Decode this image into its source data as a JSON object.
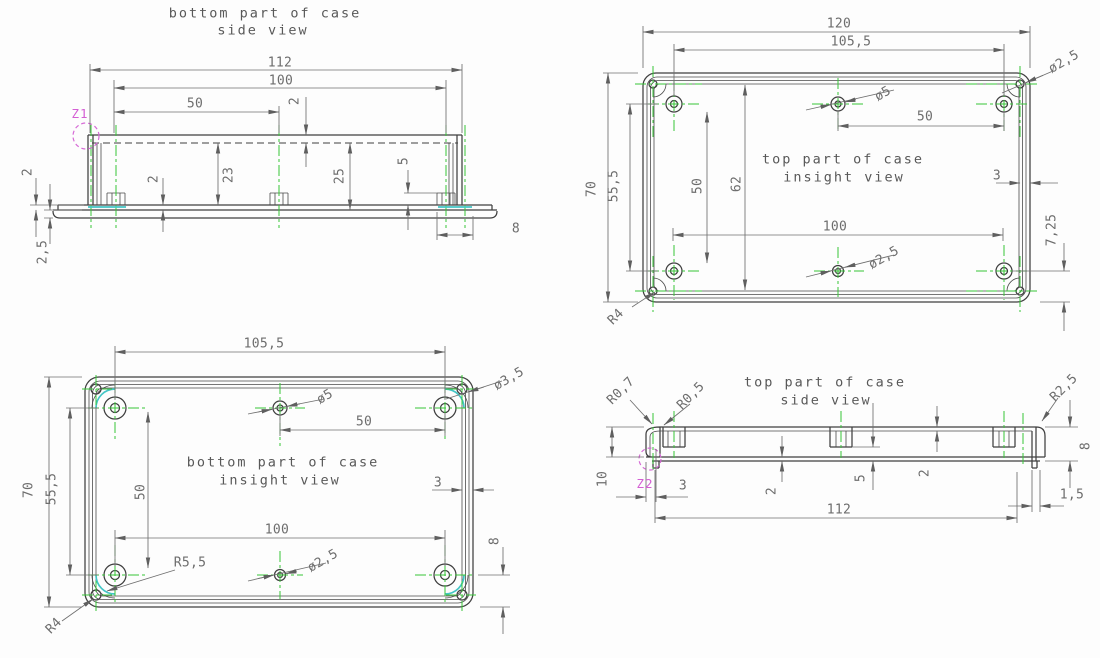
{
  "palette": {
    "background": "#fdfdfd",
    "outline": "#3f3f3f",
    "dimension": "#6f6f6f",
    "centerline_green": "#38c538",
    "zoom_magenta": "#d45fd4",
    "highlight_cyan": "#43c6c6"
  },
  "views": {
    "v1": {
      "title1": "bottom part of case",
      "title2": "side view",
      "zoom_ref": "Z1",
      "dims": {
        "d112": "112",
        "d100": "100",
        "d50": "50",
        "d2_rim": "2",
        "d2_lip": "2",
        "d2_5": "2,5",
        "d2_floor": "2",
        "d23": "23",
        "d25": "25",
        "d5": "5",
        "d8": "8"
      }
    },
    "v2": {
      "title1": "top part of case",
      "title2": "insight view",
      "dims": {
        "d120": "120",
        "d105_5": "105,5",
        "dia2_5_corner": "ø2,5",
        "dia5": "ø5",
        "d50h": "50",
        "d70": "70",
        "d55_5": "55,5",
        "d50v": "50",
        "d62": "62",
        "d100": "100",
        "dia2_5_center": "ø2,5",
        "d3": "3",
        "d7_25": "7,25",
        "r4": "R4"
      }
    },
    "v3": {
      "title1": "bottom part of case",
      "title2": "insight view",
      "dims": {
        "d105_5": "105,5",
        "dia3_5": "ø3,5",
        "dia5": "ø5",
        "d50h": "50",
        "d70": "70",
        "d55_5": "55,5",
        "d50v": "50",
        "d100": "100",
        "r5_5": "R5,5",
        "dia2_5": "ø2,5",
        "d3": "3",
        "d8": "8",
        "r4": "R4"
      }
    },
    "v4": {
      "title1": "top part of case",
      "title2": "side view",
      "zoom_ref": "Z2",
      "dims": {
        "r0_7": "R0,7",
        "r0_5": "R0,5",
        "r2_5": "R2,5",
        "d10": "10",
        "d3": "3",
        "d112": "112",
        "d1_5": "1,5",
        "d2_bottom": "2",
        "d5": "5",
        "d2_top": "2",
        "d8": "8"
      }
    }
  }
}
